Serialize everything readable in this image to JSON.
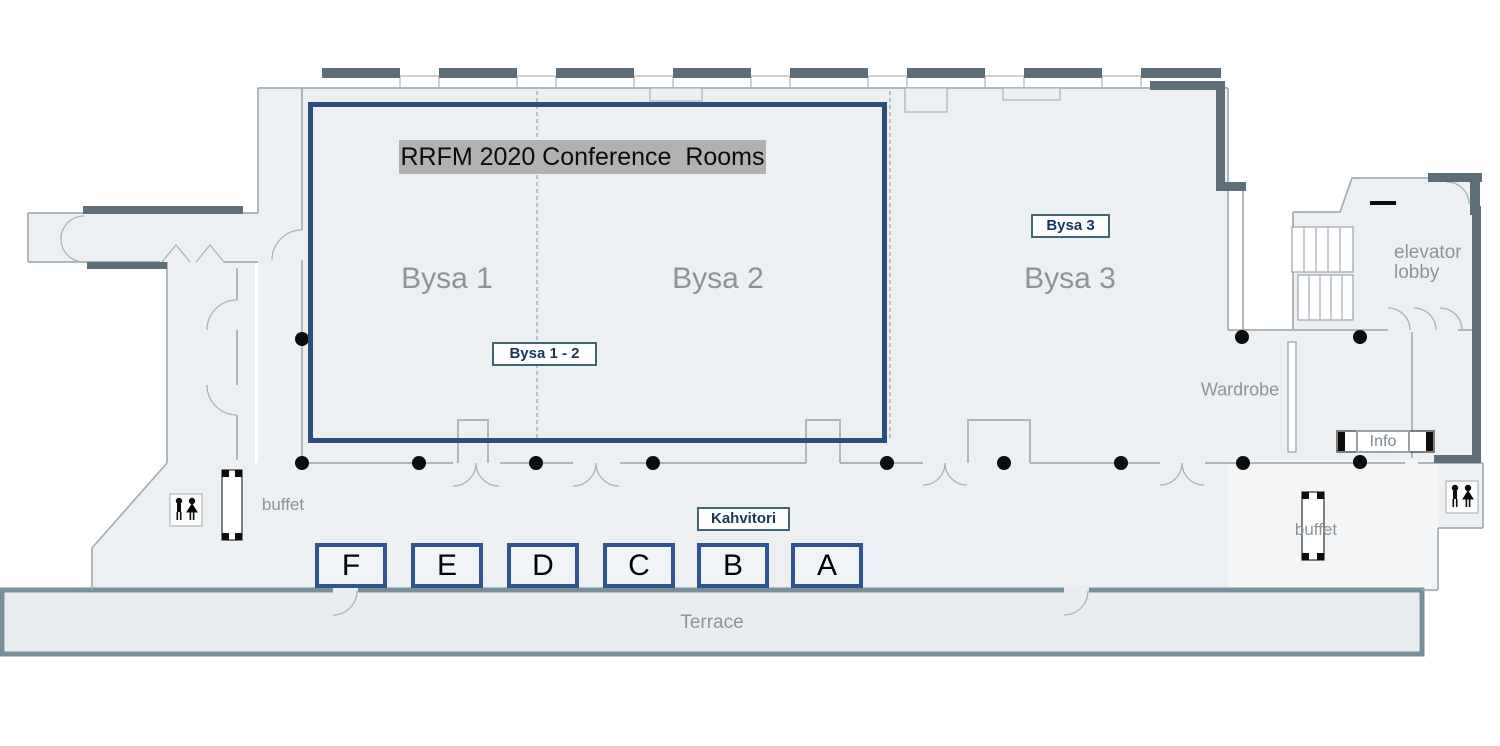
{
  "title": "RRFM 2020 Conference  Rooms",
  "rooms": {
    "bysa1": "Bysa 1",
    "bysa2": "Bysa 2",
    "bysa3": "Bysa 3"
  },
  "tags": {
    "bysa12": "Bysa 1 - 2",
    "bysa3": "Bysa 3",
    "kahvitori": "Kahvitori"
  },
  "sections": [
    "F",
    "E",
    "D",
    "C",
    "B",
    "A"
  ],
  "areas": {
    "terrace": "Terrace",
    "wardrobe": "Wardrobe",
    "info": "Info",
    "elevator_line1": "elevator",
    "elevator_line2": "lobby",
    "buffet_left": "buffet",
    "buffet_right": "buffet"
  },
  "icons": {
    "restroom": "male-female-figures"
  },
  "colors": {
    "highlight_border": "#2d4d7e",
    "section_border": "#30558e",
    "tag_border": "#3f6672",
    "tag_text": "#17365d",
    "title_highlight": "#b1b1b1",
    "floor": "#edf0f2",
    "wall": "#a3adb5",
    "dark_wall": "#5d6e79",
    "label_gray": "#8a949d"
  }
}
